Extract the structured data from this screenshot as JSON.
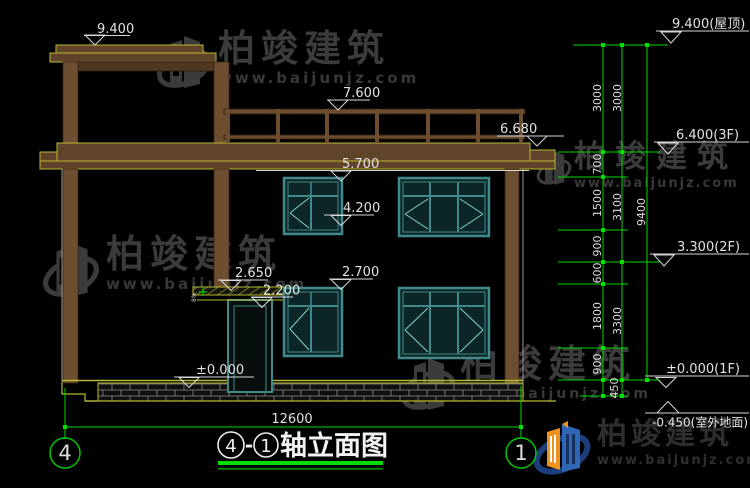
{
  "watermark": {
    "title": "柏竣建筑",
    "url": "www.baijunjz.com"
  },
  "brand_logo": {
    "title": "柏竣建筑",
    "url": "www.baijunjz.com"
  },
  "levels": {
    "l9400": "9.400",
    "l7600": "7.600",
    "l6680": "6.680",
    "l5700": "5.700",
    "l4200": "4.200",
    "l2700": "2.700",
    "l2650": "2.650",
    "l2200": "2.200",
    "lzero": "±0.000",
    "r9400": "9.400(屋顶)",
    "r6400": "6.400(3F)",
    "r3300": "3.300(2F)",
    "r0": "±0.000(1F)",
    "rneg": "-0.450(室外地面)"
  },
  "dims": {
    "inner": [
      "3000",
      "700",
      "1500",
      "900",
      "600",
      "1800",
      "900"
    ],
    "d450": "450",
    "middle": [
      "3000",
      "3100",
      "3300"
    ],
    "outer": "9400",
    "width": "12600"
  },
  "axes": {
    "left": "4",
    "right": "1"
  },
  "title": {
    "circle_left": "4",
    "separator": "-",
    "circle_right": "1",
    "caption": "轴立面图"
  },
  "note": {
    "canopy_slope": "8%"
  }
}
